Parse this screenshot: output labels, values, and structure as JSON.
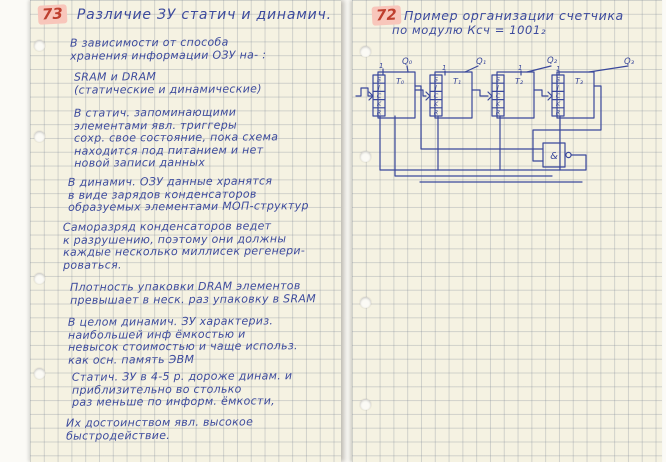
{
  "left": {
    "page_number": "73",
    "title": "Различие ЗУ статич и динамич.",
    "paragraphs": [
      [
        "В зависимости от способа",
        "хранения информации ОЗУ на- :"
      ],
      [
        "SRAM и DRAM",
        "(статические и динамические)"
      ],
      [
        "В статич. запоминающими",
        "элементами явл. триггеры",
        "сохр. свое состояние, пока схема",
        "находится под питанием и нет",
        "новой записи данных"
      ],
      [
        "В динамич. ОЗУ данные хранятся",
        "в виде зарядов конденсаторов",
        "образуемых элементами МОП-структур"
      ],
      [
        "Саморазряд конденсаторов ведет",
        "к разрушению, поэтому они должны",
        "каждые несколько миллисек регенери-",
        "роваться."
      ],
      [
        "Плотность упаковки DRAM элементов",
        "превышает в неск. раз упаковку в SRAM"
      ],
      [
        "В целом динамич. ЗУ характериз.",
        "наибольшей инф ёмкостью и",
        "невысок стоимостью и чаще использ.",
        "как осн. память ЭВМ"
      ],
      [
        "Статич. ЗУ в 4-5 р. дороже динам. и",
        "приблизительно во столько",
        "раз меньше по информ. ёмкости,"
      ],
      [
        "Их достоинством явл. высокое",
        "быстродействие."
      ]
    ]
  },
  "right": {
    "page_number": "72",
    "title_line1": "Пример организации счетчика",
    "title_line2": "по модулю Ксч = 1001₂",
    "circuit": {
      "outputs": [
        "Q₀",
        "Q₁",
        "Q₂",
        "Q₃"
      ],
      "flipflops": [
        "T₀",
        "T₁",
        "T₂",
        "T₃"
      ],
      "pins": [
        "S",
        "J",
        "C",
        "K",
        "R"
      ],
      "const_one": "1",
      "gate_label": "&"
    }
  },
  "colors": {
    "ink_blue": "#3d4b9d",
    "ink_red": "#bf3f2e",
    "highlight_pink": "#f8c6bb",
    "paper": "#f5f2e2"
  }
}
